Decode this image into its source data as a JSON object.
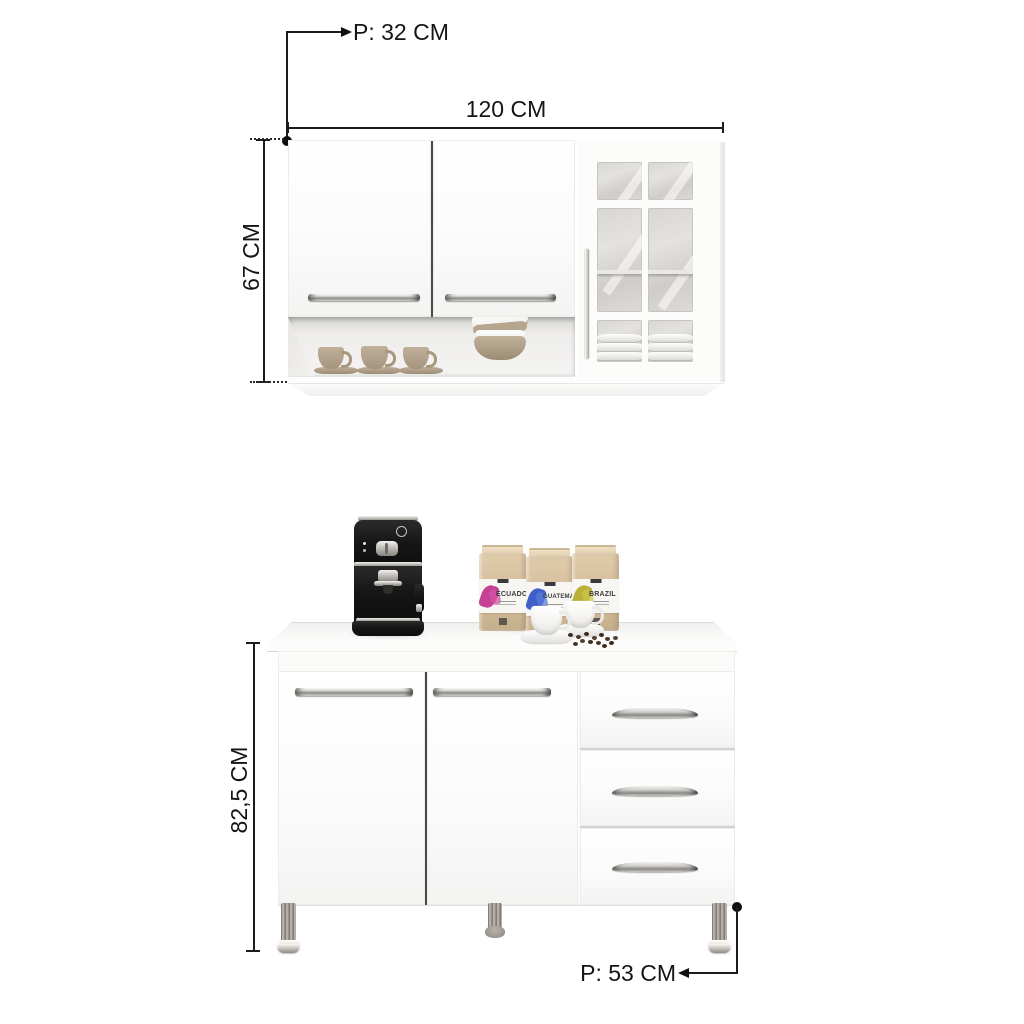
{
  "wall_cabinet": {
    "width_label": "120 CM",
    "height_label": "67 CM",
    "depth_label": "P: 32 CM"
  },
  "base_cabinet": {
    "height_label": "82,5 CM",
    "depth_label": "P: 53 CM"
  },
  "props": {
    "coffee_bags": [
      {
        "label": "ECUADOR",
        "accent": "#bf2e8a"
      },
      {
        "label": "GUATEMALA",
        "accent": "#2a50c4"
      },
      {
        "label": "BRAZIL",
        "accent": "#b3a723"
      }
    ]
  },
  "colors": {
    "background": "#ffffff",
    "cabinet_white": "#fcfcfc",
    "dimension_line": "#1c1c1c",
    "chrome": "#c9c7c3",
    "glass": "#d8d6d3",
    "kraft": "#d5bf9e",
    "machine_black": "#161616",
    "mug_tan": "#b0a088",
    "leg_gray": "#9b958e"
  }
}
